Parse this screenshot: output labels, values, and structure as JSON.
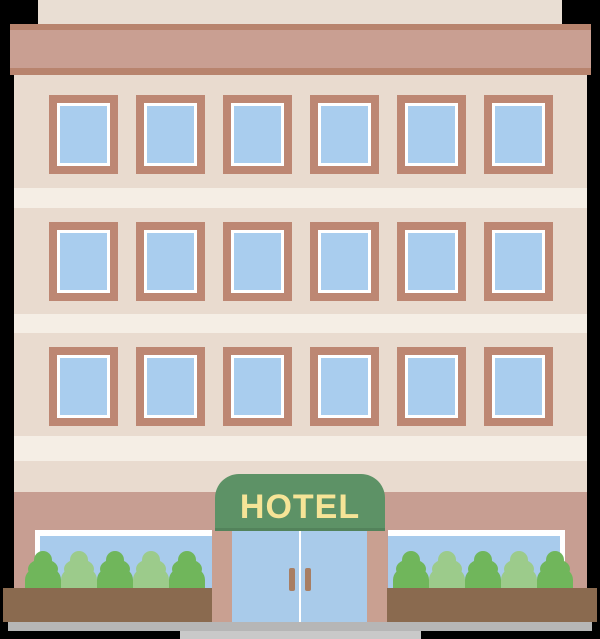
{
  "title": "Flat hotel building illustration",
  "sign": {
    "label": "HOTEL"
  },
  "building": {
    "floors": 3,
    "windows_per_floor": 6,
    "bushes_per_side": 5,
    "doors": 2
  },
  "bushes": {
    "left": [
      "dark",
      "light",
      "dark",
      "light",
      "dark"
    ],
    "right": [
      "dark",
      "light",
      "dark",
      "light",
      "dark"
    ]
  },
  "colors": {
    "background": "#000000",
    "attic": "#e9ded3",
    "cornice": "#c99f92",
    "cornice_trim": "#b8846e",
    "facade": "#e9dbcf",
    "floor_band": "#f5eee5",
    "window_frame": "#bd8773",
    "window_trim": "#ffffff",
    "window_glass": "#a9cdee",
    "ground_wall": "#c79e92",
    "storefront_glass": "#a8cbec",
    "storefront_frame": "#ffffff",
    "awning": "#5d9266",
    "awning_text": "#f6e497",
    "column": "#c9a091",
    "door_glass": "#a9cbea",
    "door_divider": "#ffffff",
    "door_handle": "#a87e63",
    "bush_dark": "#70b65b",
    "bush_light": "#9ccb8b",
    "planter": "#8a6a4f",
    "sidewalk": "#b6b6b6",
    "walkway": "#c9c9c9"
  }
}
